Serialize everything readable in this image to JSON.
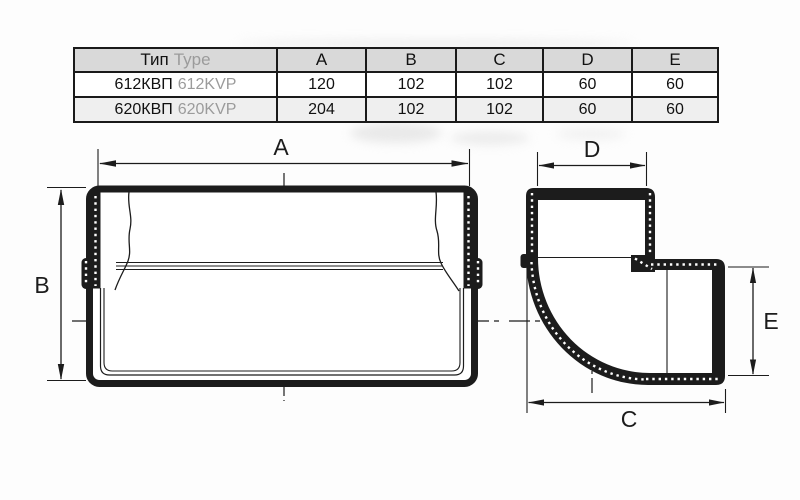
{
  "table": {
    "type_header": {
      "ru": "Тип",
      "en": "Type"
    },
    "dim_columns": [
      "A",
      "B",
      "C",
      "D",
      "E"
    ],
    "rows": [
      {
        "name_ru": "612КВП",
        "name_en": "612KVP",
        "values": [
          "120",
          "102",
          "102",
          "60",
          "60"
        ]
      },
      {
        "name_ru": "620КВП",
        "name_en": "620KVP",
        "values": [
          "204",
          "102",
          "102",
          "60",
          "60"
        ]
      }
    ]
  },
  "front_view": {
    "width_label": "A",
    "height_label": "B"
  },
  "elbow_view": {
    "top_label": "D",
    "right_label": "E",
    "bottom_label": "C"
  },
  "colors": {
    "line": "#1c1c1c",
    "table_border": "#1a1a1a",
    "table_header_bg": "#d9d9d9",
    "table_alt_row_bg": "#efefef",
    "secondary_text": "#9b9b9b",
    "background": "#fdfdfd"
  }
}
